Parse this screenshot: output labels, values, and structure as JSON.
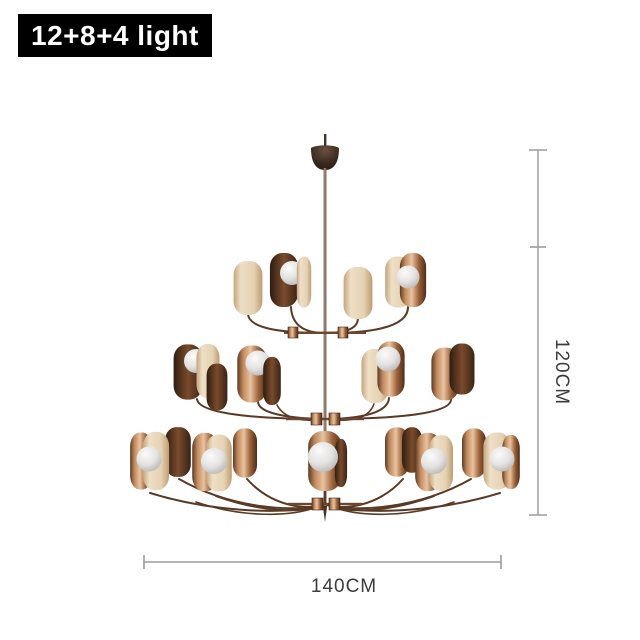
{
  "label": {
    "text": "12+8+4 light"
  },
  "dimensions": {
    "height": "120CM",
    "width": "140CM"
  },
  "product": {
    "tiers": [
      {
        "position": "top",
        "lights": 4
      },
      {
        "position": "middle",
        "lights": 8
      },
      {
        "position": "bottom",
        "lights": 12
      }
    ],
    "total_lights": 24
  },
  "colors": {
    "label_background": "#000000",
    "label_text": "#ffffff",
    "dimension_line": "#9b9b9b",
    "dimension_text": "#3c3c3c",
    "copper": "#b5805f",
    "copper_dark": "#4c2d1a",
    "champagne": "#e7d6bd",
    "glass_white": "#e9e9e9",
    "background": "#ffffff"
  }
}
